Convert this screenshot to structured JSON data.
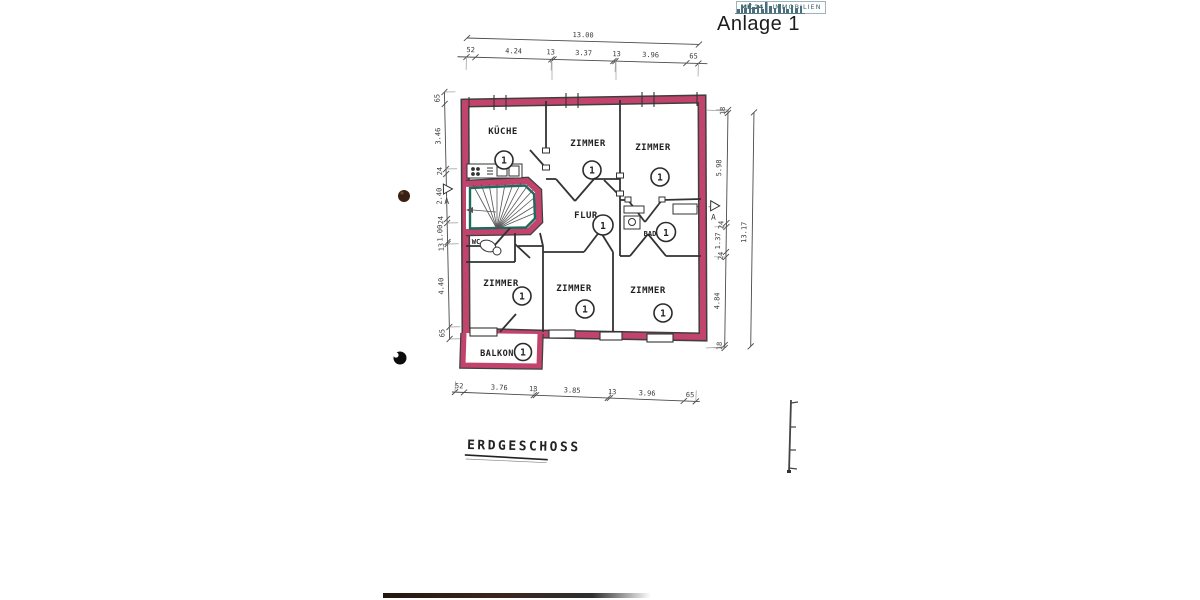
{
  "document": {
    "attachment_label": "Anlage 1",
    "floor_label": "ERDGESCHOSS",
    "logo": {
      "name_left": "MK 24",
      "name_right": "IMMOBILIEN"
    }
  },
  "plan": {
    "rooms": [
      {
        "id": "kueche",
        "name": "KÜCHE",
        "number": "1"
      },
      {
        "id": "zimmer-top-mid",
        "name": "ZIMMER",
        "number": "1"
      },
      {
        "id": "zimmer-top-right",
        "name": "ZIMMER",
        "number": "1"
      },
      {
        "id": "flur",
        "name": "FLUR",
        "number": "1"
      },
      {
        "id": "bad",
        "name": "BAD",
        "number": "1"
      },
      {
        "id": "wc",
        "name": "WC"
      },
      {
        "id": "zimmer-bottom-left",
        "name": "ZIMMER",
        "number": "1"
      },
      {
        "id": "zimmer-bottom-mid",
        "name": "ZIMMER",
        "number": "1"
      },
      {
        "id": "zimmer-bottom-right",
        "name": "ZIMMER",
        "number": "1"
      },
      {
        "id": "balkon",
        "name": "BALKON",
        "number": "1"
      }
    ],
    "section_marker": "A",
    "dimensions": {
      "top_overall": "13.00",
      "top_segments": [
        "52",
        "4.24",
        "13",
        "3.37",
        "13",
        "3.96",
        "65"
      ],
      "bottom_segments": [
        "52",
        "3.76",
        "13",
        "3.85",
        "13",
        "3.96",
        "65"
      ],
      "left_segments": [
        "65",
        "3.46",
        "24",
        "2.40",
        "24",
        "1.00",
        "13",
        "4.40",
        "65"
      ],
      "right_segments": [
        "18",
        "5.98",
        "24",
        "1.37",
        "24",
        "4.84",
        "18"
      ],
      "right_overall": "13.17"
    },
    "colors": {
      "boundary": "#c2446d",
      "stair": "#1d6b5e",
      "ink": "#2e2e2e"
    }
  }
}
